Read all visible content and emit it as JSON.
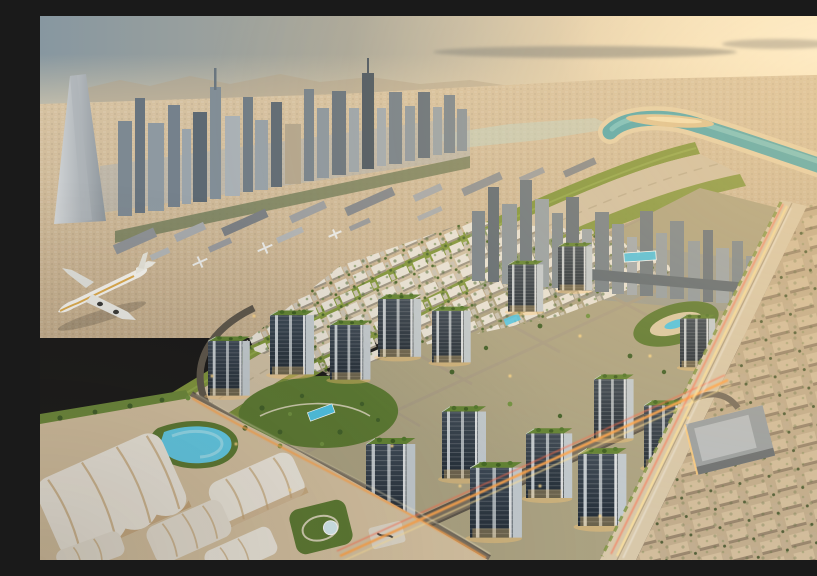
{
  "scene": {
    "title": "Golden-hour aerial view of a desert metropolis masterplan",
    "description": "Aerial render of a Dubai-style city at golden hour: a skyscraper skyline and airport aprons in the background, a turquoise canal curving through tan desert districts, mid-rise apartment towers with green rooftops, landscaped parks and swimming pools, white canopy pavilions, light-trail boulevards, and a highway beside a grid of low-rise villas.",
    "time_of_day": "golden hour",
    "features": [
      "hazy golden sky with thin gray clouds",
      "distant mountain ridge",
      "downtown skyscraper skyline with needle supertall tower",
      "airport terminals and taxiing white wide-body airplane",
      "two grass runway strips",
      "turquoise river bend with sand spit",
      "waterfront high-rise cluster with podium pool deck",
      "green-roof apartment towers with lit facades",
      "central landscaped park and pools",
      "swimming lagoon",
      "white tented pavilions",
      "garden with glass dome",
      "boulevards with orange traffic light trails",
      "highway and interchange",
      "low-rise villa grid",
      "flat-roof mall building"
    ]
  },
  "palette": {
    "sky_blue": "#8797a0",
    "sky_warm": "#f6e4c0",
    "sun_glow": "#fff6dd",
    "haze": "#e5d4b2",
    "cloud": "#8f8e86",
    "mountain": "#b4a489",
    "distant_top": "#d8c4a3",
    "distant_bottom": "#c3ad8d",
    "skyline_light": "#a8b1b7",
    "skyline_mid": "#7d8992",
    "skyline_dark": "#5a6670",
    "mega_tower": "#c7cbce",
    "river": "#4fa8b0",
    "river_light": "#8fd6d4",
    "sand_bank": "#e7d3ab",
    "sand_spit": "#dfc493",
    "grass_strip": "#80963e",
    "grass_light": "#9ab054",
    "tarmac": "#ccbda2",
    "terminal_gray": "#8e9296",
    "plane_white": "#f4f3ee",
    "plane_gold": "#d8a23c",
    "dev_ground": "#aca383",
    "park_green": "#5c7a33",
    "tree_dark": "#41602a",
    "tree_light": "#6f9140",
    "pool_blue": "#4fc4e4",
    "lagoon_blue": "#62cdea",
    "tower_side": "#c2cacf",
    "roof_green": "#628434",
    "road": "#7a6f5f",
    "road_dark": "#5e574c",
    "lane": "#a89c85",
    "trail_orange": "#ffa54d",
    "trail_yellow": "#ffe29a",
    "trail_red": "#ff6a4a",
    "glow_warm": "#ffc875",
    "tent_white": "#eee9df",
    "tent_rib": "#c8a97c",
    "sand_ground": "#d5c2a2",
    "lowrise": "#d2bd9c",
    "mall_roof": "#9ba0a2",
    "highway": "#d8c8aa"
  }
}
